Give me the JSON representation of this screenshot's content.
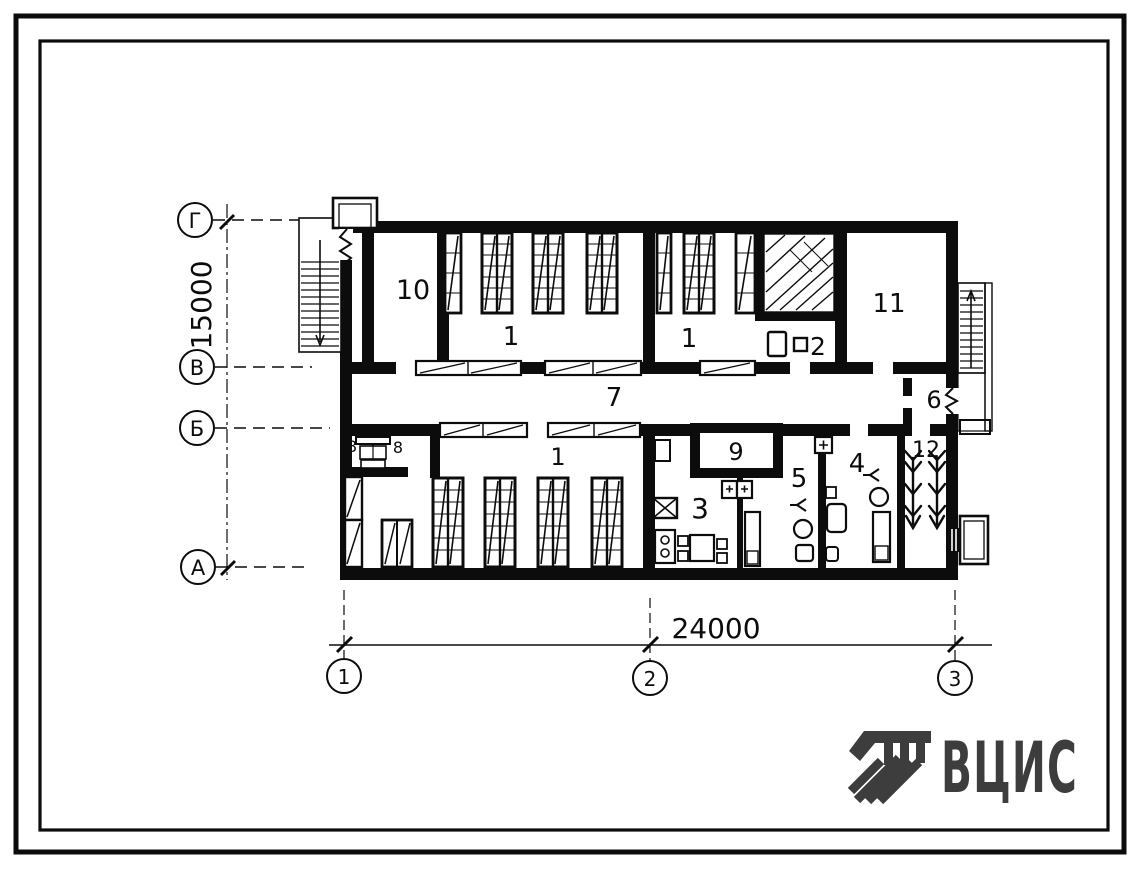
{
  "plan": {
    "rooms": [
      {
        "number": "10"
      },
      {
        "number": "1"
      },
      {
        "number": "1"
      },
      {
        "number": "2"
      },
      {
        "number": "11"
      },
      {
        "number": "7"
      },
      {
        "number": "6"
      },
      {
        "number": "8"
      },
      {
        "number": "8"
      },
      {
        "number": "1"
      },
      {
        "number": "3"
      },
      {
        "number": "9"
      },
      {
        "number": "5"
      },
      {
        "number": "4"
      },
      {
        "number": "12"
      }
    ],
    "axes": {
      "rows": [
        {
          "label": "Г"
        },
        {
          "label": "В"
        },
        {
          "label": "Б"
        },
        {
          "label": "А"
        }
      ],
      "cols": [
        {
          "label": "1"
        },
        {
          "label": "2"
        },
        {
          "label": "3"
        }
      ]
    },
    "dimensions": {
      "horizontal": "24000",
      "vertical": "15000"
    }
  },
  "logo": {
    "text": "ВЦИС",
    "color": "#3d3d3d"
  },
  "colors": {
    "ink": "#0c0c0c",
    "paper": "#ffffff"
  }
}
